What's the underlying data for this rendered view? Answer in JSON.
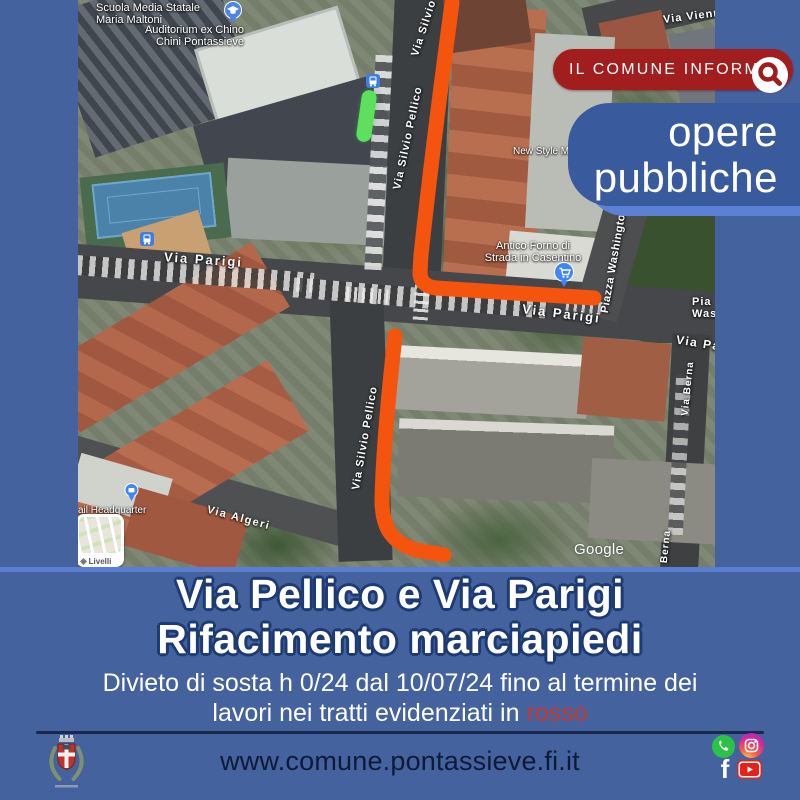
{
  "poster": {
    "badge_red": {
      "label": "IL COMUNE INFORMA"
    },
    "badge_blue": {
      "line1": "opere",
      "line2": "pubbliche"
    },
    "title": {
      "line1": "Via Pellico e Via Parigi",
      "line2": "Rifacimento marciapiedi"
    },
    "notice": {
      "part1": "Divieto di sosta h 0/24 dal 10/07/24 fino al termine dei\nlavori nei tratti evidenziati in ",
      "highlight": "rosso"
    },
    "footer": {
      "website": "www.comune.pontassieve.fi.it",
      "crest": "stemma-comune-pontassieve",
      "social_icons": [
        "whatsapp",
        "instagram",
        "facebook",
        "youtube"
      ]
    },
    "colors": {
      "background": "#44629e",
      "badge_red": "#a21d1d",
      "badge_blue": "#3a5a9e",
      "badge_blue_light": "#5c80d4",
      "route_highlight": "#f4540e",
      "notice_highlight": "#c7382c",
      "divider": "#19294e"
    }
  },
  "map": {
    "labels": {
      "scuola_line1": "Scuola Media Statale",
      "scuola_line2": "Maria Maltoni",
      "auditorium_line1": "Auditorium ex Chino",
      "auditorium_line2": "Chini Pontassieve",
      "via_vienna": "Via Vienna",
      "via_silvio": "Via Silvio",
      "via_silvio_pellico_upper": "Via Silvio Pellico",
      "via_silvio_pellico_lower": "Via Silvio Pellico",
      "via_parigi_west": "Via Parigi",
      "via_parigi_east": "Via Parigi",
      "via_parigi_edge": "Via Pa",
      "via_algeri": "Via Algeri",
      "piazza_washington": "Piazza Washington",
      "piazza_washington_cut_line1": "Pia",
      "piazza_washington_cut_line2": "Wash",
      "via_berna": "Via Berna",
      "via_berna_cut": "Berna",
      "new_style": "New Style M",
      "antico_forno_line1": "Antico Forno di",
      "antico_forno_line2": "Strada in Casentino",
      "mail_headquarter": "ail  Headquarter",
      "layers_control": "Livelli",
      "attribution": "Google"
    }
  }
}
